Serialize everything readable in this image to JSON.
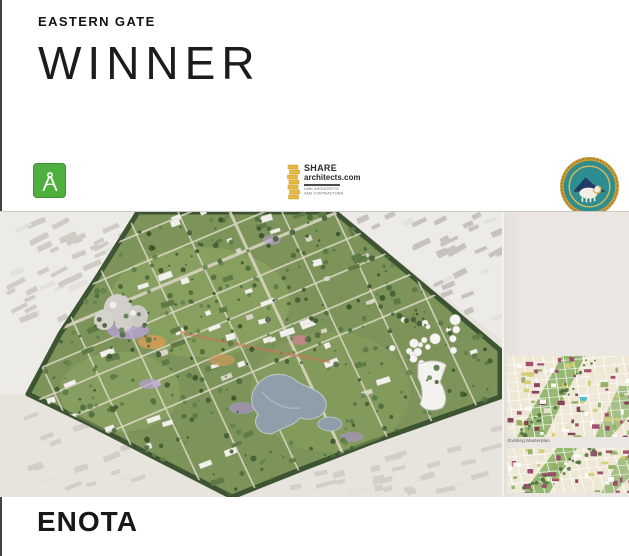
{
  "header": {
    "eyebrow": "EASTERN GATE",
    "title": "WINNER"
  },
  "logos": {
    "compass": {
      "bg_color": "#4faf3e"
    },
    "share": {
      "name": "SHARE",
      "domain": "architects.com",
      "tagline1": "LINK ARCHITECTS",
      "tagline2": "AND CONTRACTORS",
      "accent_color": "#e6b93f"
    },
    "emblem": {
      "ring_color": "#c79b3b",
      "field_color": "#2e8e8f"
    }
  },
  "right_panel": {
    "caption": "Existing Masterplan"
  },
  "footer": {
    "studio": "ENOTA"
  }
}
